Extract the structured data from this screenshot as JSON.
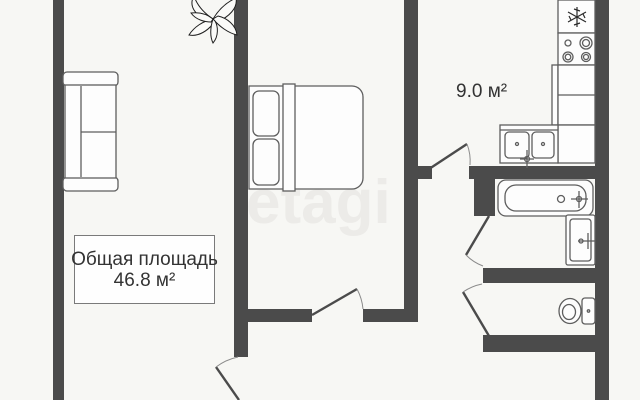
{
  "watermark": "etagi",
  "labels": {
    "total_area_title": "Общая площадь",
    "total_area_value": "46.8 м²",
    "kitchen_area": "9.0 м²"
  },
  "colors": {
    "wall": "#4b4b4b",
    "background": "#f7f7f4",
    "outline": "#5e5e5e",
    "text": "#333333",
    "watermark": "#ecebe8",
    "box_border": "#7a7a7a"
  },
  "furniture": {
    "living_room": [
      "sofa"
    ],
    "bedroom": [
      "double-bed",
      "plant"
    ],
    "kitchen": [
      "fridge",
      "stove",
      "counter",
      "double-sink"
    ],
    "bathroom": [
      "bathtub",
      "washbasin"
    ],
    "wc": [
      "toilet"
    ]
  }
}
